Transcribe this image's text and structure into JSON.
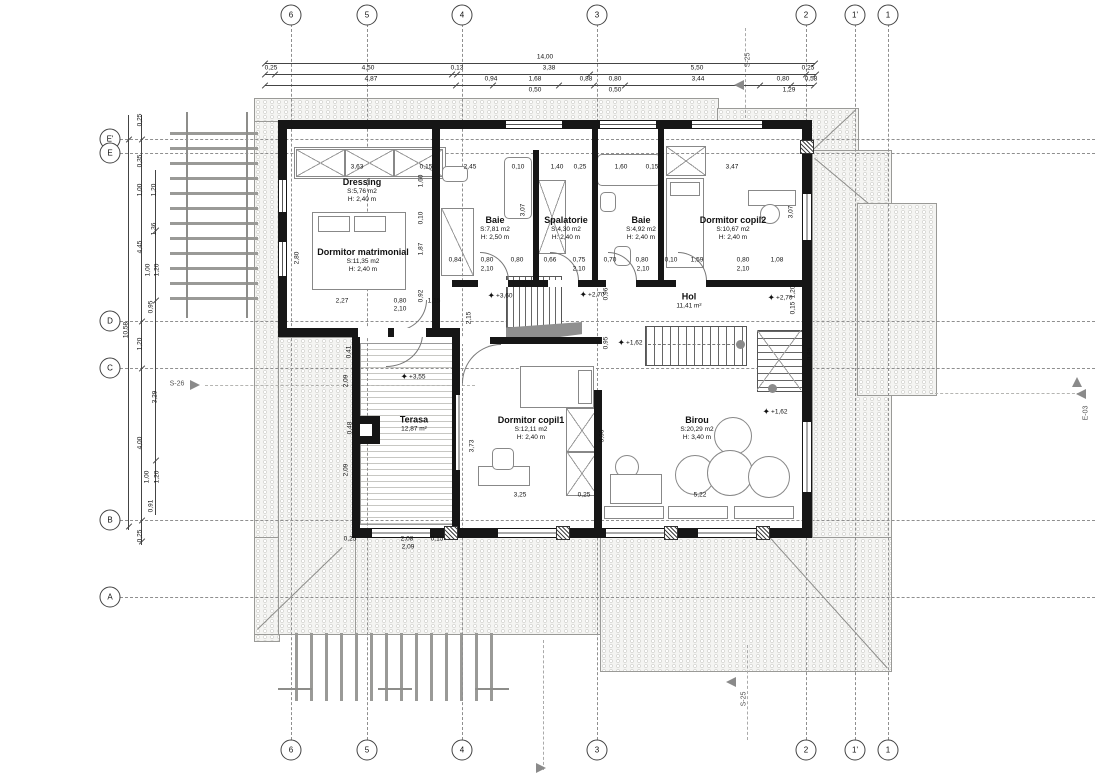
{
  "drawing": {
    "grid_cols": [
      {
        "label": "6",
        "x": 291
      },
      {
        "label": "5",
        "x": 367
      },
      {
        "label": "4",
        "x": 462
      },
      {
        "label": "3",
        "x": 597
      },
      {
        "label": "2",
        "x": 806
      },
      {
        "label": "1'",
        "x": 855
      },
      {
        "label": "1",
        "x": 888
      }
    ],
    "grid_rows": [
      {
        "label": "E'",
        "y": 139
      },
      {
        "label": "E",
        "y": 153
      },
      {
        "label": "D",
        "y": 321
      },
      {
        "label": "C",
        "y": 368
      },
      {
        "label": "B",
        "y": 520
      },
      {
        "label": "A",
        "y": 597
      }
    ],
    "rooms": [
      {
        "name": "Dressing",
        "area": "S:5,76 m2",
        "height": "H: 2,40 m",
        "x": 362,
        "y": 190
      },
      {
        "name": "Dormitor matrimonial",
        "area": "S:11,35 m2",
        "height": "H: 2,40 m",
        "x": 363,
        "y": 260
      },
      {
        "name": "Baie",
        "area": "S:7,81 m2",
        "height": "H: 2,50 m",
        "x": 495,
        "y": 228
      },
      {
        "name": "Spalatorie",
        "area": "S:4,30 m2",
        "height": "H: 2,40 m",
        "x": 566,
        "y": 228
      },
      {
        "name": "Baie",
        "area": "S:4,92 m2",
        "height": "H: 2,40 m",
        "x": 641,
        "y": 228
      },
      {
        "name": "Dormitor copil2",
        "area": "S:10,67 m2",
        "height": "H: 2,40 m",
        "x": 733,
        "y": 228
      },
      {
        "name": "Hol",
        "area": "11,41 m²",
        "height": "",
        "x": 689,
        "y": 301
      },
      {
        "name": "Terasa",
        "area": "12,87 m²",
        "height": "",
        "x": 414,
        "y": 424
      },
      {
        "name": "Dormitor copil1",
        "area": "S:12,11 m2",
        "height": "H: 2,40 m",
        "x": 531,
        "y": 428
      },
      {
        "name": "Birou",
        "area": "S:20,29 m2",
        "height": "H: 3,40 m",
        "x": 697,
        "y": 428
      }
    ],
    "levels": [
      {
        "t": "+3,60",
        "x": 500,
        "y": 296
      },
      {
        "t": "+2,70",
        "x": 592,
        "y": 295
      },
      {
        "t": "+2,70",
        "x": 780,
        "y": 298
      },
      {
        "t": "+1,62",
        "x": 630,
        "y": 343
      },
      {
        "t": "+1,62",
        "x": 775,
        "y": 412
      },
      {
        "t": "+3,55",
        "x": 413,
        "y": 377
      }
    ],
    "sections": [
      {
        "t": "S-25",
        "x": 748,
        "y": 60,
        "rot": true
      },
      {
        "t": "S-26",
        "x": 177,
        "y": 384
      },
      {
        "t": "E-03",
        "x": 1086,
        "y": 413,
        "rot": true
      },
      {
        "t": "S-25",
        "x": 744,
        "y": 699,
        "rot": true
      }
    ],
    "dims_top": [
      {
        "t": "14,00",
        "x": 545,
        "y": 57
      },
      {
        "t": "0,25",
        "x": 271,
        "y": 68
      },
      {
        "t": "4,50",
        "x": 368,
        "y": 68
      },
      {
        "t": "0,13",
        "x": 457,
        "y": 68
      },
      {
        "t": "3,38",
        "x": 549,
        "y": 68
      },
      {
        "t": "5,50",
        "x": 697,
        "y": 68
      },
      {
        "t": "0,25",
        "x": 808,
        "y": 68
      },
      {
        "t": "4,87",
        "x": 371,
        "y": 79
      },
      {
        "t": "0,94",
        "x": 491,
        "y": 79
      },
      {
        "t": "1,68",
        "x": 535,
        "y": 79
      },
      {
        "t": "0,88",
        "x": 586,
        "y": 79
      },
      {
        "t": "0,80",
        "x": 615,
        "y": 79
      },
      {
        "t": "3,44",
        "x": 698,
        "y": 79
      },
      {
        "t": "0,80",
        "x": 783,
        "y": 79
      },
      {
        "t": "0,58",
        "x": 811,
        "y": 79
      },
      {
        "t": "0,50",
        "x": 535,
        "y": 90
      },
      {
        "t": "0,50",
        "x": 615,
        "y": 90
      },
      {
        "t": "1,29",
        "x": 789,
        "y": 90
      }
    ],
    "dims_left": [
      {
        "t": "10,58",
        "x": 126,
        "y": 330,
        "rot": true
      },
      {
        "t": "0,25",
        "x": 140,
        "y": 120,
        "rot": true
      },
      {
        "t": "0,35",
        "x": 140,
        "y": 161,
        "rot": true
      },
      {
        "t": "1,00",
        "x": 140,
        "y": 190,
        "rot": true
      },
      {
        "t": "1,20",
        "x": 154,
        "y": 190,
        "rot": true
      },
      {
        "t": "1,36",
        "x": 154,
        "y": 229,
        "rot": true
      },
      {
        "t": "4,45",
        "x": 140,
        "y": 247,
        "rot": true
      },
      {
        "t": "1,00",
        "x": 148,
        "y": 270,
        "rot": true
      },
      {
        "t": "1,20",
        "x": 157,
        "y": 270,
        "rot": true
      },
      {
        "t": "0,95",
        "x": 151,
        "y": 307,
        "rot": true
      },
      {
        "t": "1,20",
        "x": 140,
        "y": 344,
        "rot": true
      },
      {
        "t": "3,29",
        "x": 155,
        "y": 397,
        "rot": true
      },
      {
        "t": "4,00",
        "x": 140,
        "y": 443,
        "rot": true
      },
      {
        "t": "1,00",
        "x": 147,
        "y": 477,
        "rot": true
      },
      {
        "t": "1,20",
        "x": 157,
        "y": 477,
        "rot": true
      },
      {
        "t": "0,91",
        "x": 151,
        "y": 506,
        "rot": true
      },
      {
        "t": "0,25",
        "x": 140,
        "y": 536,
        "rot": true
      }
    ],
    "dims_inner": [
      {
        "t": "3,63",
        "x": 357,
        "y": 167
      },
      {
        "t": "0,15",
        "x": 426,
        "y": 167
      },
      {
        "t": "2,45",
        "x": 470,
        "y": 167
      },
      {
        "t": "0,10",
        "x": 518,
        "y": 167
      },
      {
        "t": "1,40",
        "x": 557,
        "y": 167
      },
      {
        "t": "0,25",
        "x": 580,
        "y": 167
      },
      {
        "t": "1,60",
        "x": 621,
        "y": 167
      },
      {
        "t": "0,15",
        "x": 652,
        "y": 167
      },
      {
        "t": "3,47",
        "x": 732,
        "y": 167
      },
      {
        "t": "0,84",
        "x": 455,
        "y": 260
      },
      {
        "t": "0,80",
        "x": 487,
        "y": 260
      },
      {
        "t": "0,80",
        "x": 517,
        "y": 260
      },
      {
        "t": "0,66",
        "x": 550,
        "y": 260
      },
      {
        "t": "0,75",
        "x": 579,
        "y": 260
      },
      {
        "t": "0,70",
        "x": 610,
        "y": 260
      },
      {
        "t": "0,80",
        "x": 642,
        "y": 260
      },
      {
        "t": "0,10",
        "x": 671,
        "y": 260
      },
      {
        "t": "1,59",
        "x": 697,
        "y": 260
      },
      {
        "t": "0,80",
        "x": 743,
        "y": 260
      },
      {
        "t": "1,08",
        "x": 777,
        "y": 260
      },
      {
        "t": "2,10",
        "x": 487,
        "y": 269
      },
      {
        "t": "2,10",
        "x": 579,
        "y": 269
      },
      {
        "t": "2,10",
        "x": 643,
        "y": 269
      },
      {
        "t": "2,10",
        "x": 743,
        "y": 269
      },
      {
        "t": "2,27",
        "x": 342,
        "y": 301
      },
      {
        "t": "0,80",
        "x": 400,
        "y": 301
      },
      {
        "t": "1,15",
        "x": 434,
        "y": 301
      },
      {
        "t": "2,10",
        "x": 400,
        "y": 309
      },
      {
        "t": "3,25",
        "x": 520,
        "y": 495
      },
      {
        "t": "0,25",
        "x": 584,
        "y": 495
      },
      {
        "t": "5,22",
        "x": 700,
        "y": 495
      },
      {
        "t": "0,25",
        "x": 350,
        "y": 539
      },
      {
        "t": "2,08",
        "x": 407,
        "y": 539
      },
      {
        "t": "0,15",
        "x": 437,
        "y": 539
      },
      {
        "t": "2,09",
        "x": 408,
        "y": 547
      },
      {
        "t": "2,80",
        "x": 297,
        "y": 258,
        "rot": true
      },
      {
        "t": "1,60",
        "x": 421,
        "y": 181,
        "rot": true
      },
      {
        "t": "0,10",
        "x": 421,
        "y": 218,
        "rot": true
      },
      {
        "t": "1,87",
        "x": 421,
        "y": 249,
        "rot": true
      },
      {
        "t": "0,92",
        "x": 421,
        "y": 296,
        "rot": true
      },
      {
        "t": "2,15",
        "x": 469,
        "y": 318,
        "rot": true
      },
      {
        "t": "3,07",
        "x": 523,
        "y": 210,
        "rot": true
      },
      {
        "t": "3,07",
        "x": 791,
        "y": 212,
        "rot": true
      },
      {
        "t": "0,96",
        "x": 606,
        "y": 294,
        "rot": true
      },
      {
        "t": "0,95",
        "x": 606,
        "y": 343,
        "rot": true
      },
      {
        "t": "1,20",
        "x": 793,
        "y": 292,
        "rot": true
      },
      {
        "t": "0,15",
        "x": 793,
        "y": 308,
        "rot": true
      },
      {
        "t": "0,95",
        "x": 810,
        "y": 354,
        "rot": true
      },
      {
        "t": "3,73",
        "x": 472,
        "y": 446,
        "rot": true
      },
      {
        "t": "0,41",
        "x": 349,
        "y": 352,
        "rot": true
      },
      {
        "t": "2,09",
        "x": 346,
        "y": 381,
        "rot": true
      },
      {
        "t": "2,09",
        "x": 346,
        "y": 470,
        "rot": true
      },
      {
        "t": "0,48",
        "x": 350,
        "y": 428,
        "rot": true
      },
      {
        "t": "3,06",
        "x": 602,
        "y": 436,
        "rot": true
      }
    ]
  }
}
